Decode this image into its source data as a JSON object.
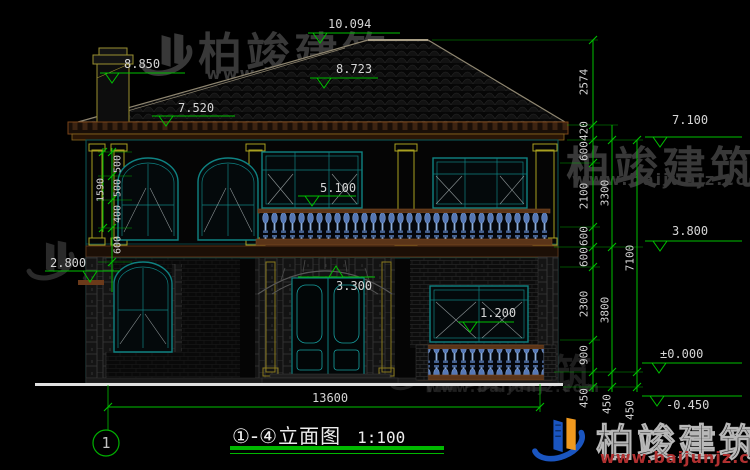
{
  "title": {
    "name": "①-④立面图",
    "scale": "1:100",
    "axis_bubble": "1"
  },
  "elevation_marks": {
    "ridge": "10.094",
    "left_upper": "8.850",
    "left_roof": "8.723",
    "roof_mid": "7.520",
    "right_eave": "7.100",
    "floor2_window": "5.100",
    "right_floor2": "3.800",
    "door_arch": "3.300",
    "left_ledge": "2.800",
    "porch_window": "1.200",
    "ground_zero": "±0.000",
    "ground_below": "-0.450"
  },
  "dimensions": {
    "right_chain_inner": [
      "2574",
      "420",
      "600",
      "2100",
      "600",
      "600",
      "2300",
      "900",
      "450"
    ],
    "right_chain_middle": [
      "3300",
      "3800",
      "450"
    ],
    "right_chain_outer": [
      "7100",
      "450"
    ],
    "left_chain_segments": [
      "500",
      "500",
      "400",
      "600"
    ],
    "left_chain_overall": "1590",
    "overall_width": "13600"
  },
  "watermark": {
    "brand": "柏竣建筑",
    "url": "www.baijunjz.com"
  },
  "colors": {
    "dimension_green": "#00c000",
    "line_teal": "#0e8080",
    "accent_yellow": "#a8a020",
    "fascia_brown": "#6b3a1a",
    "baluster_blue": "#7d9fd4",
    "logo_blue": "#1a55c0",
    "logo_orange": "#f0991e",
    "url_red": "#b03030"
  }
}
